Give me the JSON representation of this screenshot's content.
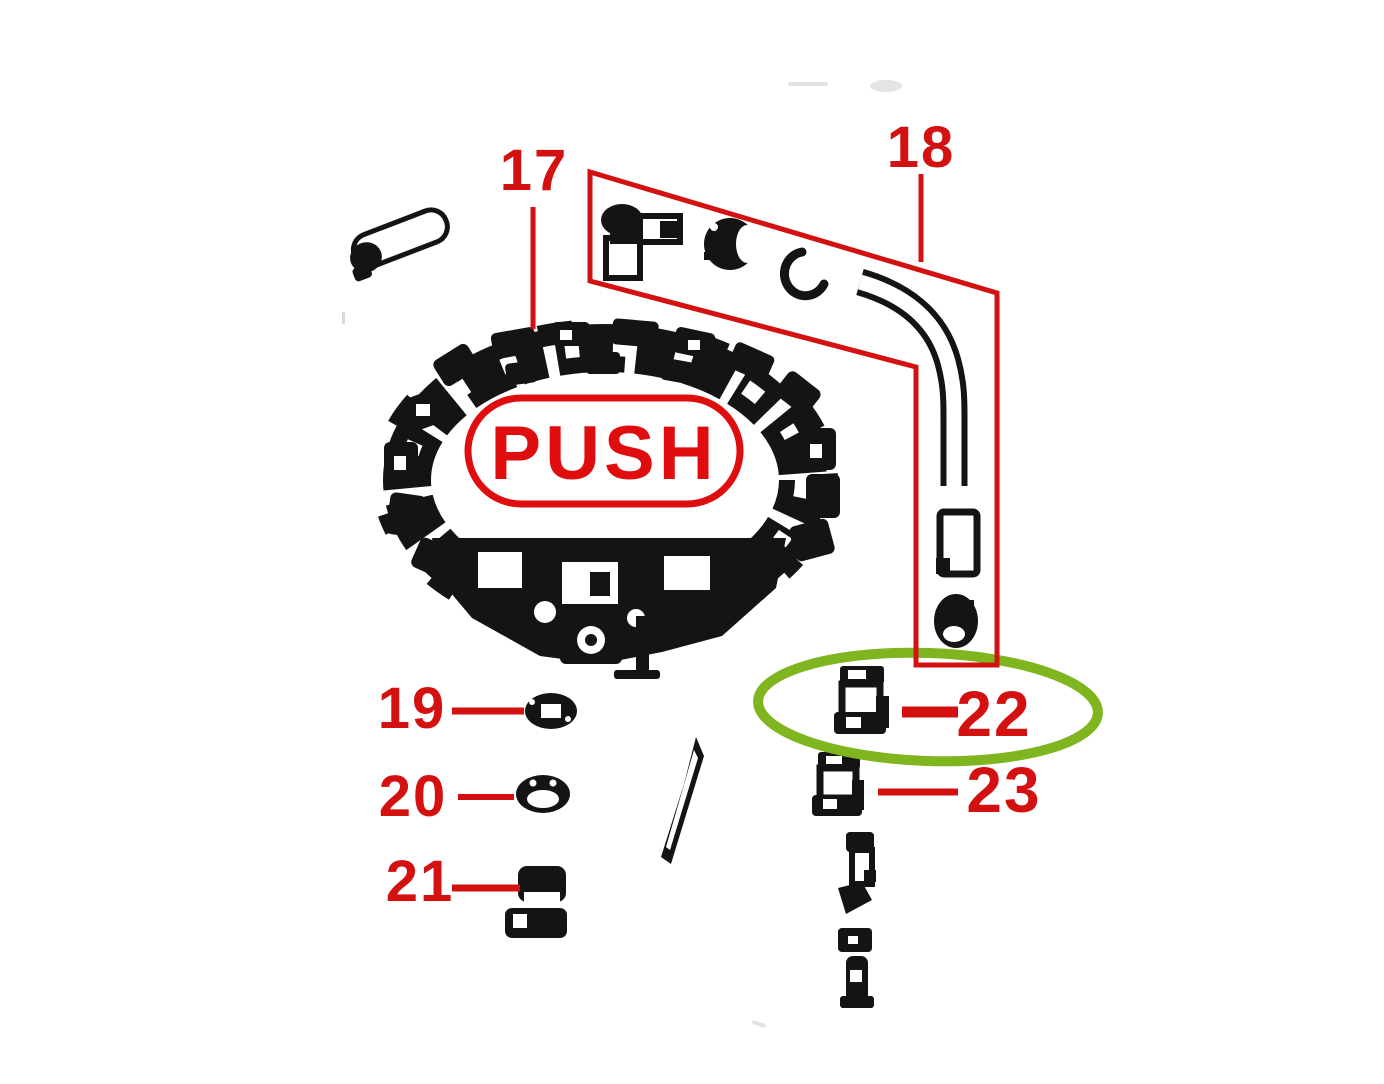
{
  "diagram": {
    "push_label": "PUSH",
    "callouts": [
      {
        "number": "17",
        "highlighted": false
      },
      {
        "number": "18",
        "highlighted": false
      },
      {
        "number": "19",
        "highlighted": false
      },
      {
        "number": "20",
        "highlighted": false
      },
      {
        "number": "21",
        "highlighted": false
      },
      {
        "number": "22",
        "highlighted": true
      },
      {
        "number": "23",
        "highlighted": false
      }
    ]
  },
  "colors": {
    "callout_red": "#d31111",
    "push_red": "#df0d0d",
    "highlight_green": "#7fb51f",
    "line_black": "#141414",
    "background": "#ffffff"
  }
}
